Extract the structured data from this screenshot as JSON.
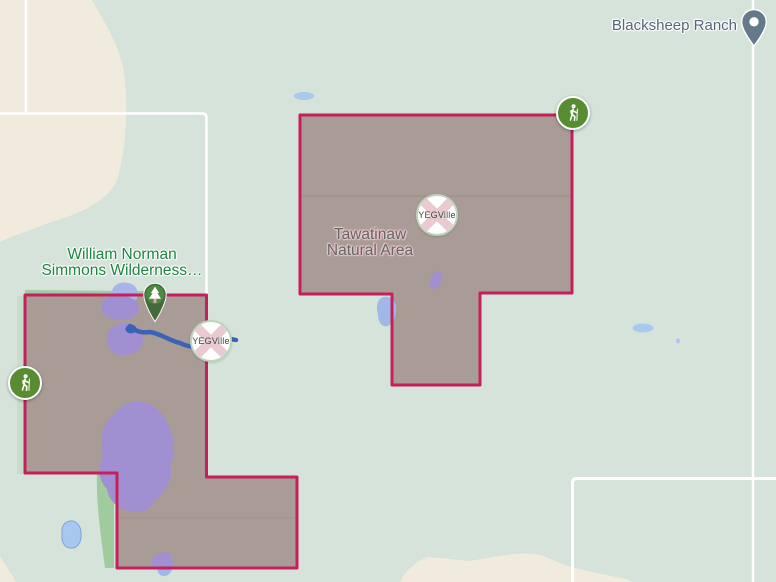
{
  "map": {
    "labels": {
      "blacksheep_ranch": "Blacksheep Ranch",
      "wilderness_line1": "William Norman",
      "wilderness_line2": "Simmons Wilderness…",
      "tawatinaw_line1": "Tawatinaw",
      "tawatinaw_line2": "Natural Area"
    },
    "watermark": {
      "label": "YEGVille"
    },
    "markers": {
      "blacksheep_pin": "place-pin",
      "park_tree_pin": "park-pin",
      "trailhead_icons": [
        "hiker-icon-tawatinaw",
        "hiker-icon-wilderness"
      ]
    },
    "colors": {
      "background_green": "#d5e3da",
      "open_terrain_beige": "#f0ebdc",
      "protected_area_fill": "#a99c96",
      "protected_area_border": "#c51f5c",
      "wetland_purple": "#a090d2",
      "water_light_blue": "#a9c8f0",
      "stream_blue": "#3a63b6",
      "vegetation_strip_green": "#a2cba5",
      "road_white": "#ffffff",
      "trail_icon_green": "#578c30",
      "park_label_green": "#1d8540",
      "area_label_olive": "#5d6b60",
      "poi_label_slate": "#54667a",
      "pin_slate": "#64798b"
    }
  }
}
